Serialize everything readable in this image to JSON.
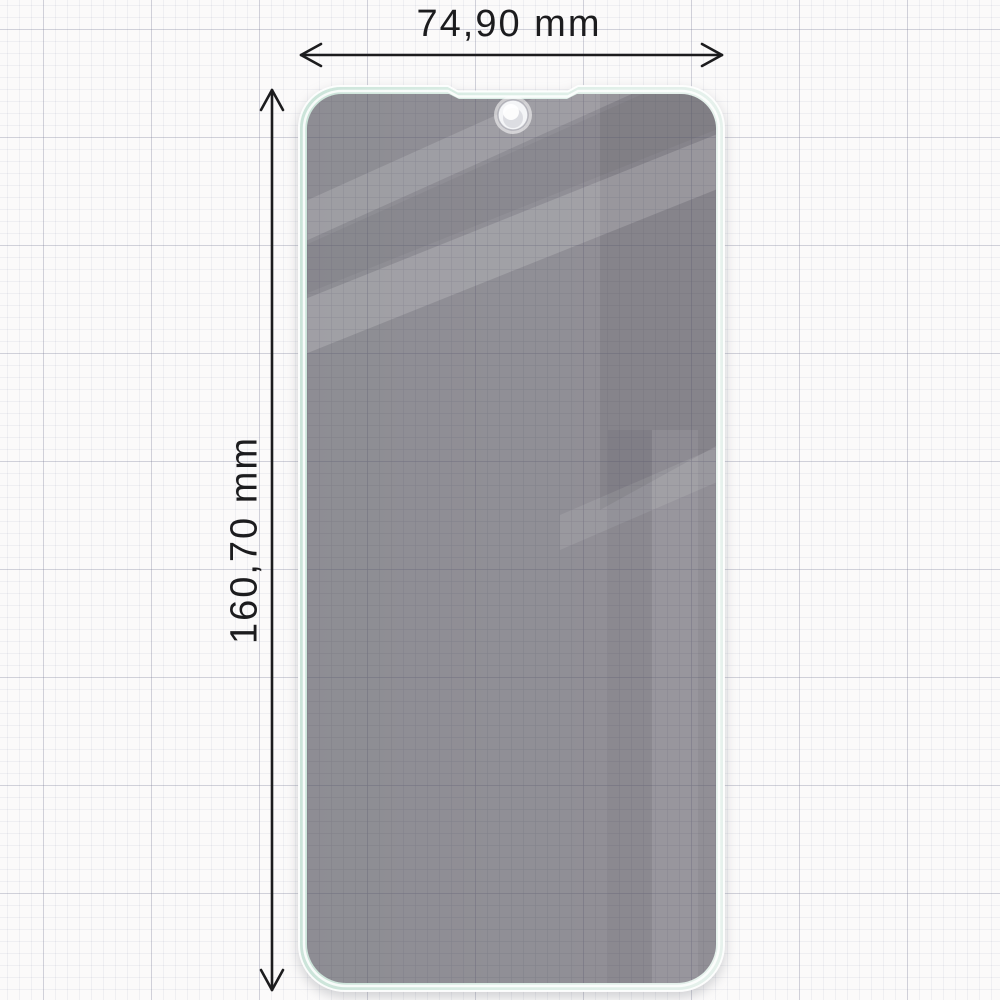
{
  "diagram": {
    "product": "privacy-screen-protector",
    "width_dimension": {
      "label": "74,90 mm"
    },
    "height_dimension": {
      "label": "160,70 mm"
    },
    "unit": "mm",
    "icons": {
      "camera_hole": "punch-hole-cutout"
    },
    "colors": {
      "dimension_ink": "#1c1c1e",
      "paper": "#fbfafa",
      "grid_minor": "#e8e8ee",
      "grid_major": "#d3d3dc",
      "protector_border_mint": "#d9ece4",
      "glass_tint": "#939096",
      "glass_reflection": "#aaa6ae",
      "camera_hole_fill": "#f4f5f7"
    }
  }
}
